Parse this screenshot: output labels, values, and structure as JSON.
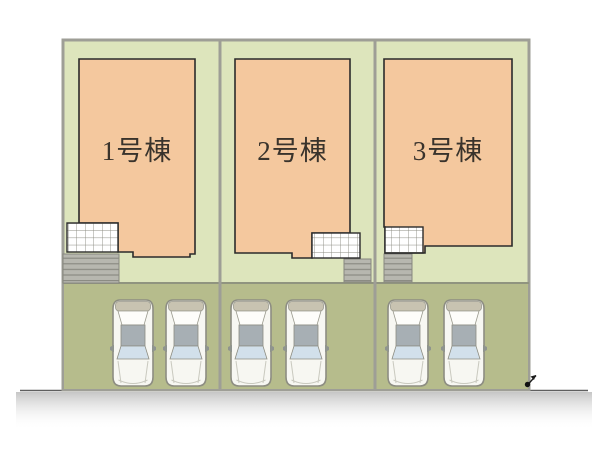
{
  "plan": {
    "lots": [
      {
        "label": "1号棟",
        "parked_cars": 2
      },
      {
        "label": "2号棟",
        "parked_cars": 2
      },
      {
        "label": "3号棟",
        "parked_cars": 2
      }
    ]
  },
  "icons": {
    "corner_marker": "boundary-point-arrow"
  },
  "colors": {
    "lot_ground": "#dde5bc",
    "parking_ground": "#b6bc8c",
    "building_fill": "#f4c89e",
    "building_outline": "#2b2b2b",
    "boundary_gray": "#9e9e96",
    "steps_gray": "#b7b7af",
    "road_gray": "#c6c6c6",
    "car_roof": "#a7afb4",
    "windshield_blue": "#d2e0eb",
    "label_text": "#39332c"
  }
}
